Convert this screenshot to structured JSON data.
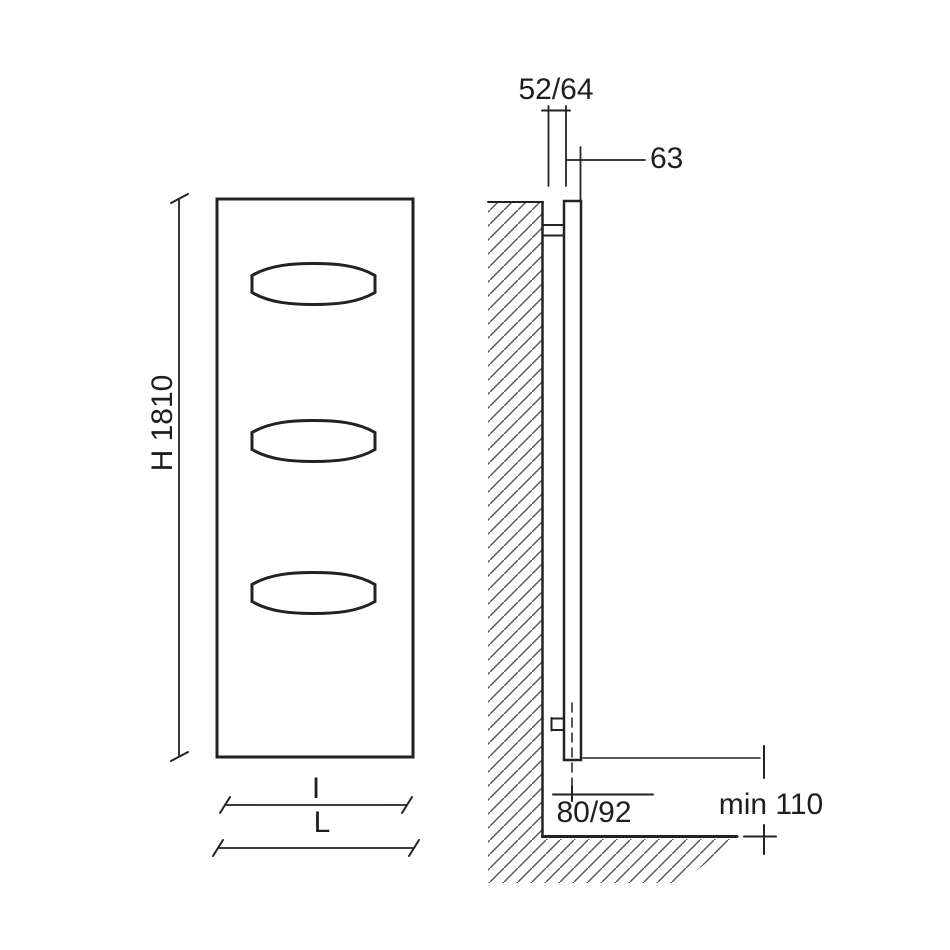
{
  "diagram": {
    "kind": "radiator-installation-dimension-drawing",
    "front_view": {
      "height_label": "H 1810",
      "inner_width_label": "I",
      "overall_width_label": "L"
    },
    "side_view": {
      "depth_label": "52/64",
      "wall_offset_label": "63",
      "pipe_axis_label": "80/92",
      "floor_clearance_label": "min 110"
    },
    "colors": {
      "background": "#ffffff",
      "line": "#222222",
      "hatch": "#555555",
      "text": "#1e1e1e"
    }
  }
}
